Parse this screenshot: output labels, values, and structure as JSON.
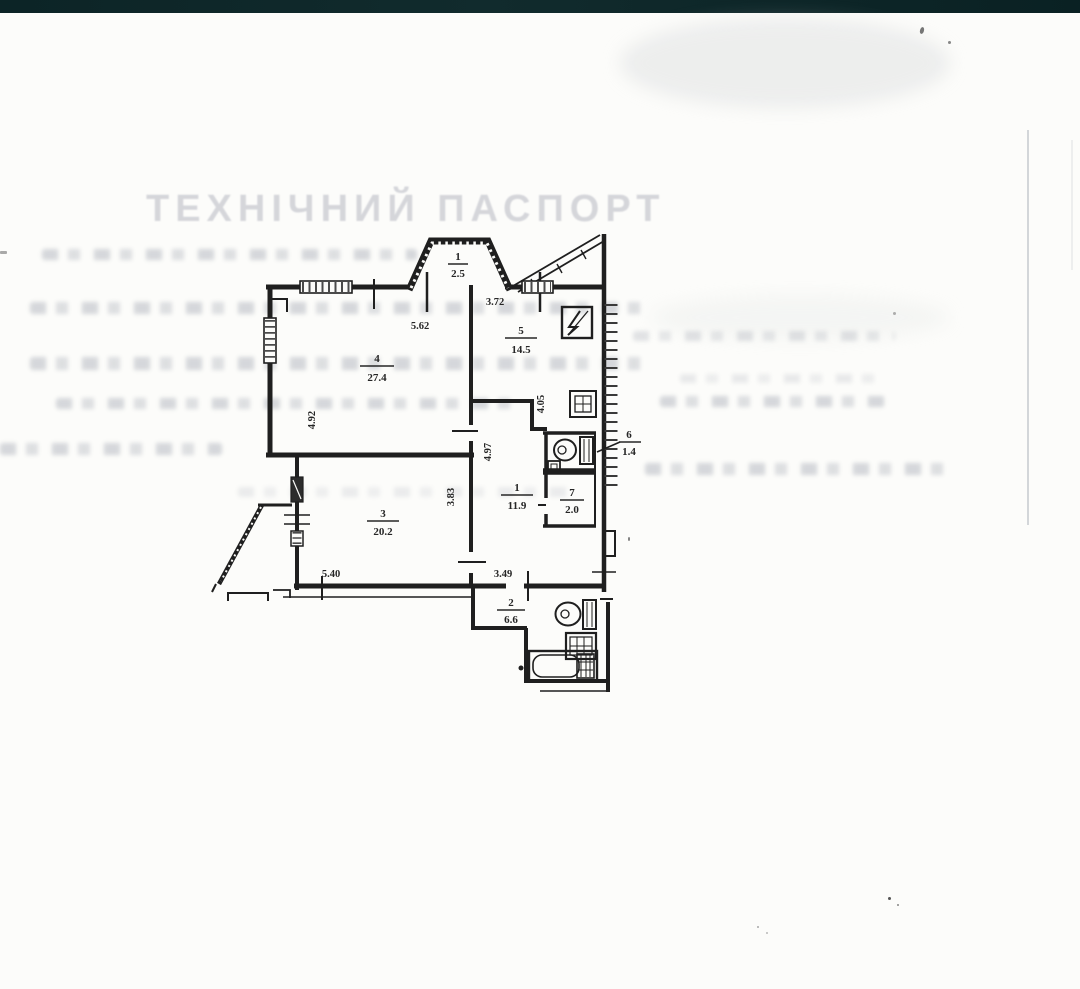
{
  "watermark": {
    "title": "ТЕХНІЧНИЙ ПАСПОРТ"
  },
  "scan": {
    "top_bar_color": "#0c2426",
    "paper_color": "#fcfcfa",
    "ink_color": "#1f1f1f",
    "watermark_color": "#d3d4d9"
  },
  "plan": {
    "rooms": [
      {
        "id": "bay-window",
        "num": "1",
        "area": "2.5"
      },
      {
        "id": "living-room",
        "num": "4",
        "area": "27.4"
      },
      {
        "id": "kitchen",
        "num": "5",
        "area": "14.5"
      },
      {
        "id": "wc",
        "num": "6",
        "area": "1.4"
      },
      {
        "id": "closet",
        "num": "7",
        "area": "2.0"
      },
      {
        "id": "hallway",
        "num": "1",
        "area": "11.9"
      },
      {
        "id": "bedroom",
        "num": "3",
        "area": "20.2"
      },
      {
        "id": "bathroom",
        "num": "2",
        "area": "6.6"
      }
    ],
    "dims": [
      {
        "text": "5.62"
      },
      {
        "text": "3.72"
      },
      {
        "text": "4.92"
      },
      {
        "text": "4.05"
      },
      {
        "text": "4.97"
      },
      {
        "text": "3.83"
      },
      {
        "text": "5.40"
      },
      {
        "text": "3.49"
      }
    ],
    "icons": {
      "electric_panel": "square-with-lightning-bolt",
      "toilet": "oval-bowl-with-tank",
      "sink": "hatched-square",
      "bathtub": "rounded-tub"
    }
  }
}
